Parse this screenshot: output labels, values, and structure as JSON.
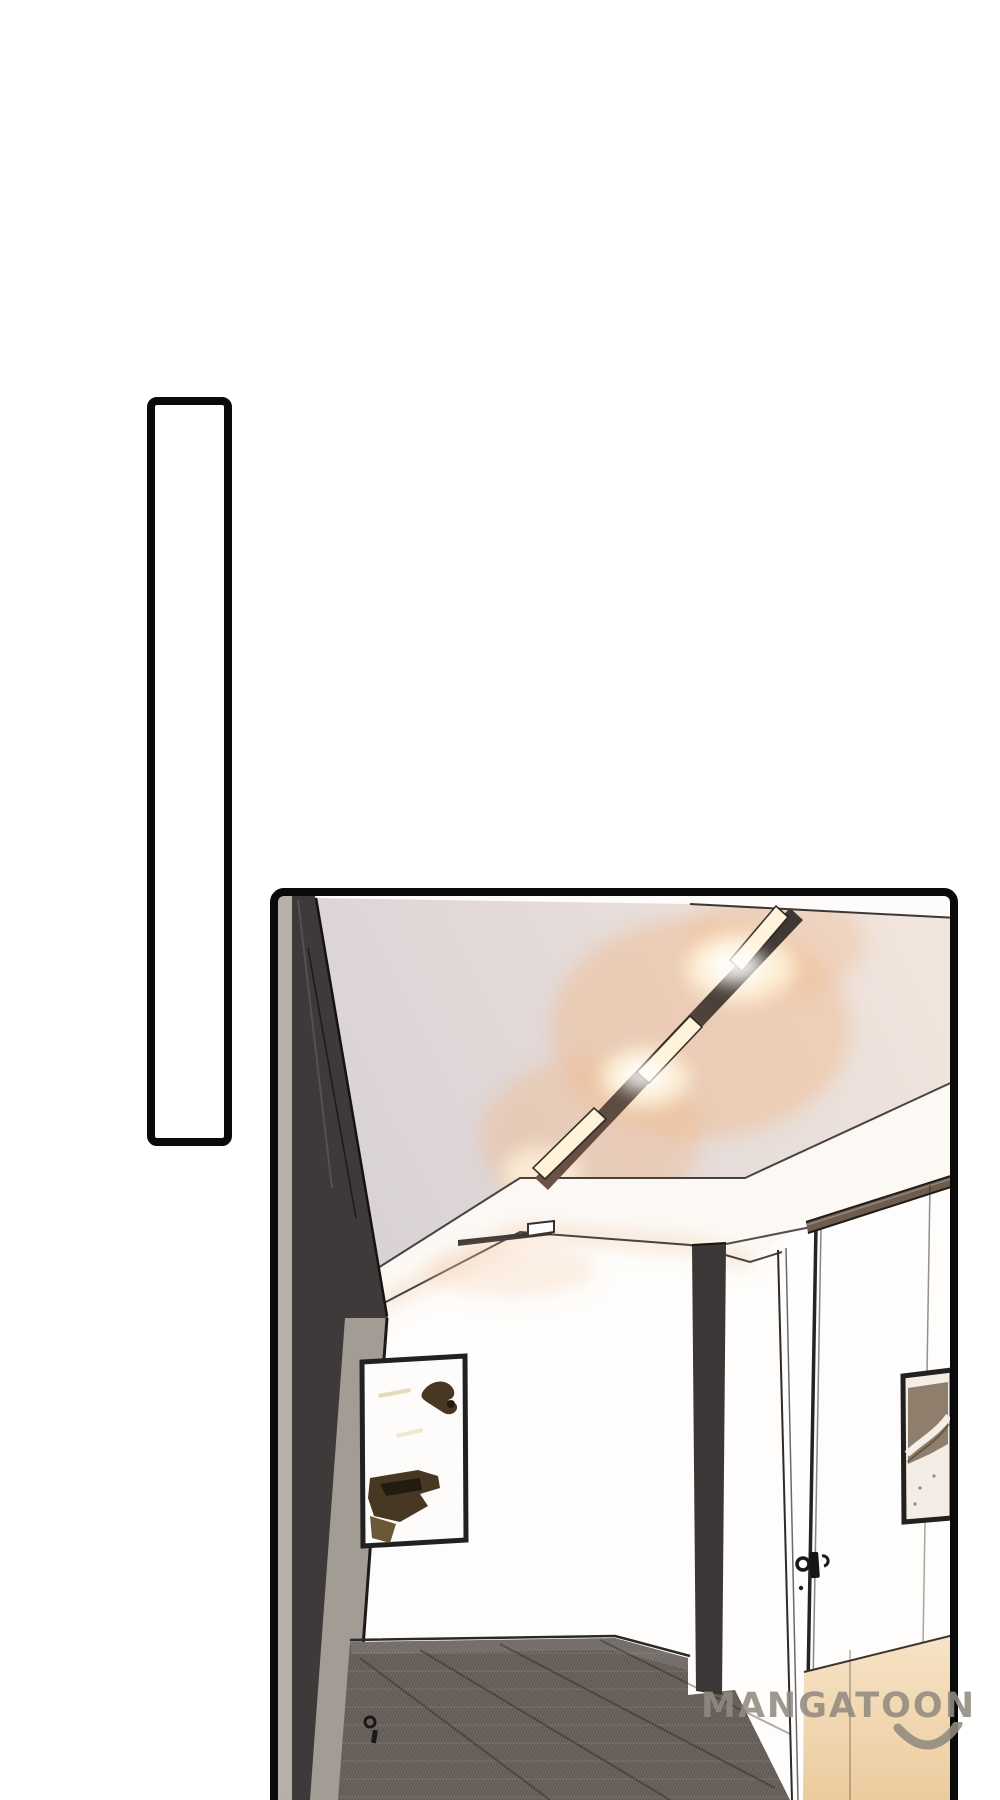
{
  "page": {
    "width": 1000,
    "height": 1800,
    "background": "#ffffff"
  },
  "watermark": {
    "text": "MANGATOON",
    "color": "rgba(145,138,128,0.88)"
  },
  "panels": {
    "empty": {
      "kind": "blank vertical panel",
      "fill": "#ffffff"
    },
    "scene": {
      "kind": "office hallway interior with linear ceiling lights, two picture frames, doors and carpet"
    }
  },
  "colors": {
    "panel_border": "#0a0a0a",
    "ink": "#242120",
    "ceiling_left": "#d8d1d5",
    "ceiling_right": "#f0e4dc",
    "top_strip": "#fdfcfa",
    "soffit": "#fcf9f5",
    "glow_warm": "#f0b98c",
    "glow_hot": "#fff3da",
    "beam_dark": "#3c3734",
    "beam_lit": "#6b5344",
    "wedge_dark": "#3e3a39",
    "wedge_gray": "#a29c94",
    "wedge_sliver": "#b5b1a9",
    "wall": "#fefdfb",
    "rail_wood": "#6e5d4c",
    "post": "#3b3736",
    "carpet": "#6e6661",
    "tan_top": "#f7e3c6",
    "tan_bottom": "#ebcc9e",
    "frame_border": "#232120",
    "art_brown": "#463823",
    "art_brown_dark": "#241b10",
    "art_brown_light": "#6b5836",
    "art_taupe": "#8f7e6b",
    "art_pale": "#f3ede5"
  }
}
